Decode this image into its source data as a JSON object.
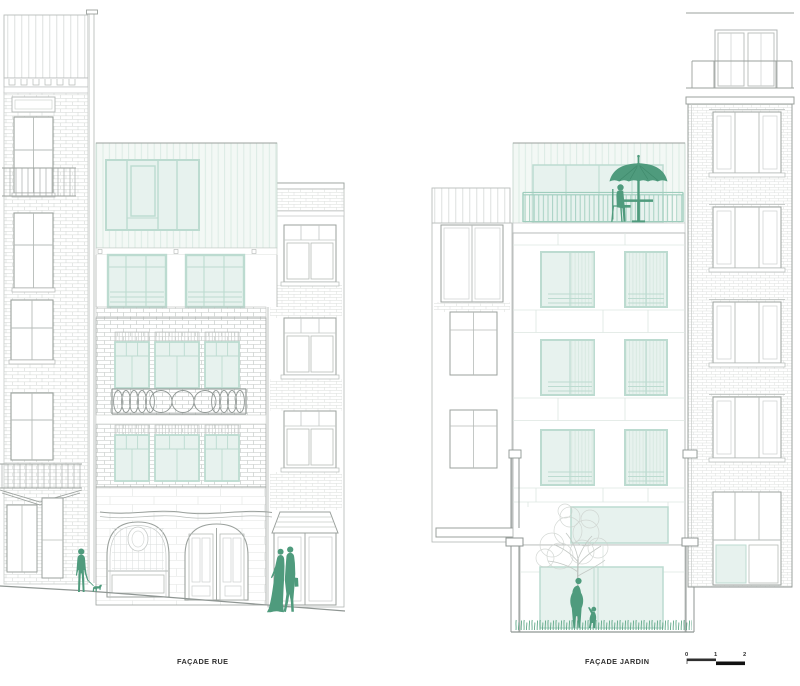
{
  "page": {
    "background": "#ffffff",
    "width": 800,
    "height": 686
  },
  "panels": [
    {
      "id": "facade-rue",
      "label": "FAÇADE RUE"
    },
    {
      "id": "facade-jardin",
      "label": "FAÇADE JARDIN"
    }
  ],
  "scale_bar": {
    "ticks": [
      "0",
      "1",
      "2"
    ]
  },
  "colors": {
    "accent_green": "#4f9b7d",
    "railing_green": "#9fcdbd",
    "grass_green": "#5fa888",
    "glass_fill": "#e7f2ee",
    "glass_frame": "#bcdbd0",
    "siding_fill": "#f3f8f5",
    "siding_line": "#dcebe4",
    "outline_gray": "#9ba19d",
    "detail_gray": "#b6bbb8",
    "brick_gray": "#c8ccca",
    "text_color": "#2f2f2f"
  }
}
